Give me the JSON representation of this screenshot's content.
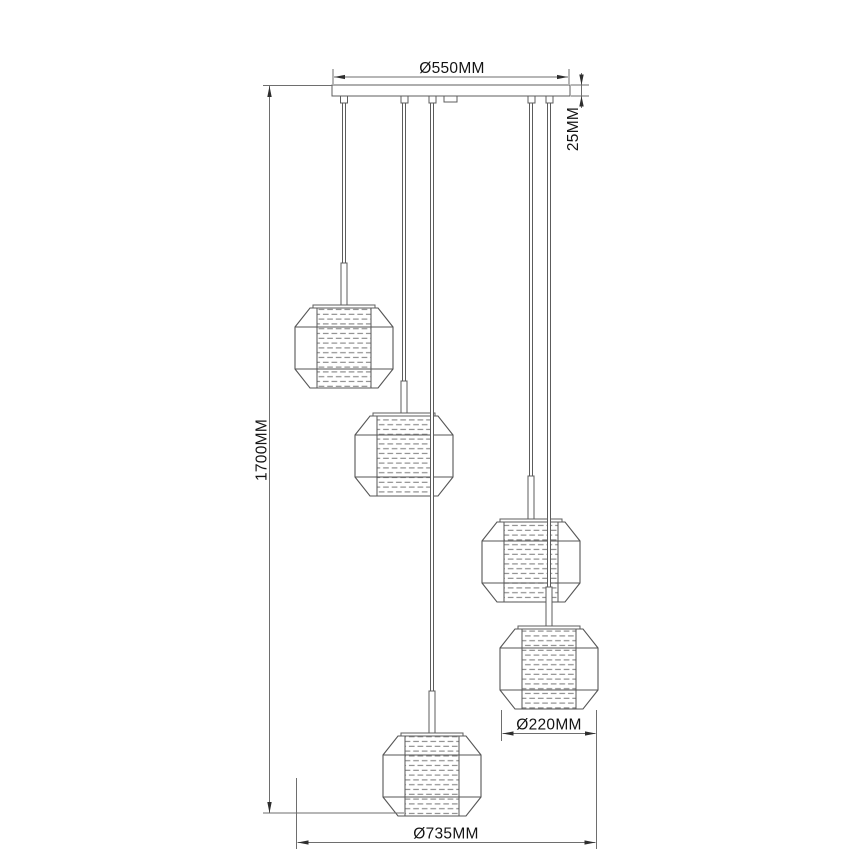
{
  "drawing": {
    "type": "technical-dimension-diagram",
    "subject": "5-light cluster pendant lamp line drawing",
    "background": "#ffffff",
    "line_color": "#565656",
    "dim_line_color": "#6e6e6e",
    "text_color": "#141414",
    "mesh_color": "#8c8c8c",
    "dimensions": {
      "canopy_diameter": "Ø550MM",
      "canopy_thickness": "25MM",
      "overall_drop": "1700MM",
      "shade_diameter": "Ø220MM",
      "cluster_spread": "Ø735MM"
    },
    "canopy": {
      "x": 332,
      "y": 85,
      "width": 238,
      "height": 11,
      "center_box": {
        "x": 444,
        "y": 96,
        "width": 13,
        "height": 6
      },
      "gripper_xs": [
        344,
        404.5,
        432.5,
        531.5,
        549.5
      ],
      "gripper_size": 7
    },
    "pendants": [
      {
        "cx": 344,
        "top": 308,
        "stem_top": 263
      },
      {
        "cx": 404,
        "top": 416,
        "stem_top": 381
      },
      {
        "cx": 531,
        "top": 522,
        "stem_top": 476
      },
      {
        "cx": 549,
        "top": 629,
        "stem_top": 587
      },
      {
        "cx": 432,
        "top": 736,
        "stem_top": 691
      }
    ],
    "shade": {
      "width": 98,
      "height": 80,
      "top_half_width": 34,
      "shoulder_y": 19,
      "hip_y": 61,
      "mesh_half_width": 27,
      "cap_half_width": 31,
      "cap_height": 3,
      "stem_width": 6,
      "cord_width": 3,
      "cord_top": 103
    }
  }
}
